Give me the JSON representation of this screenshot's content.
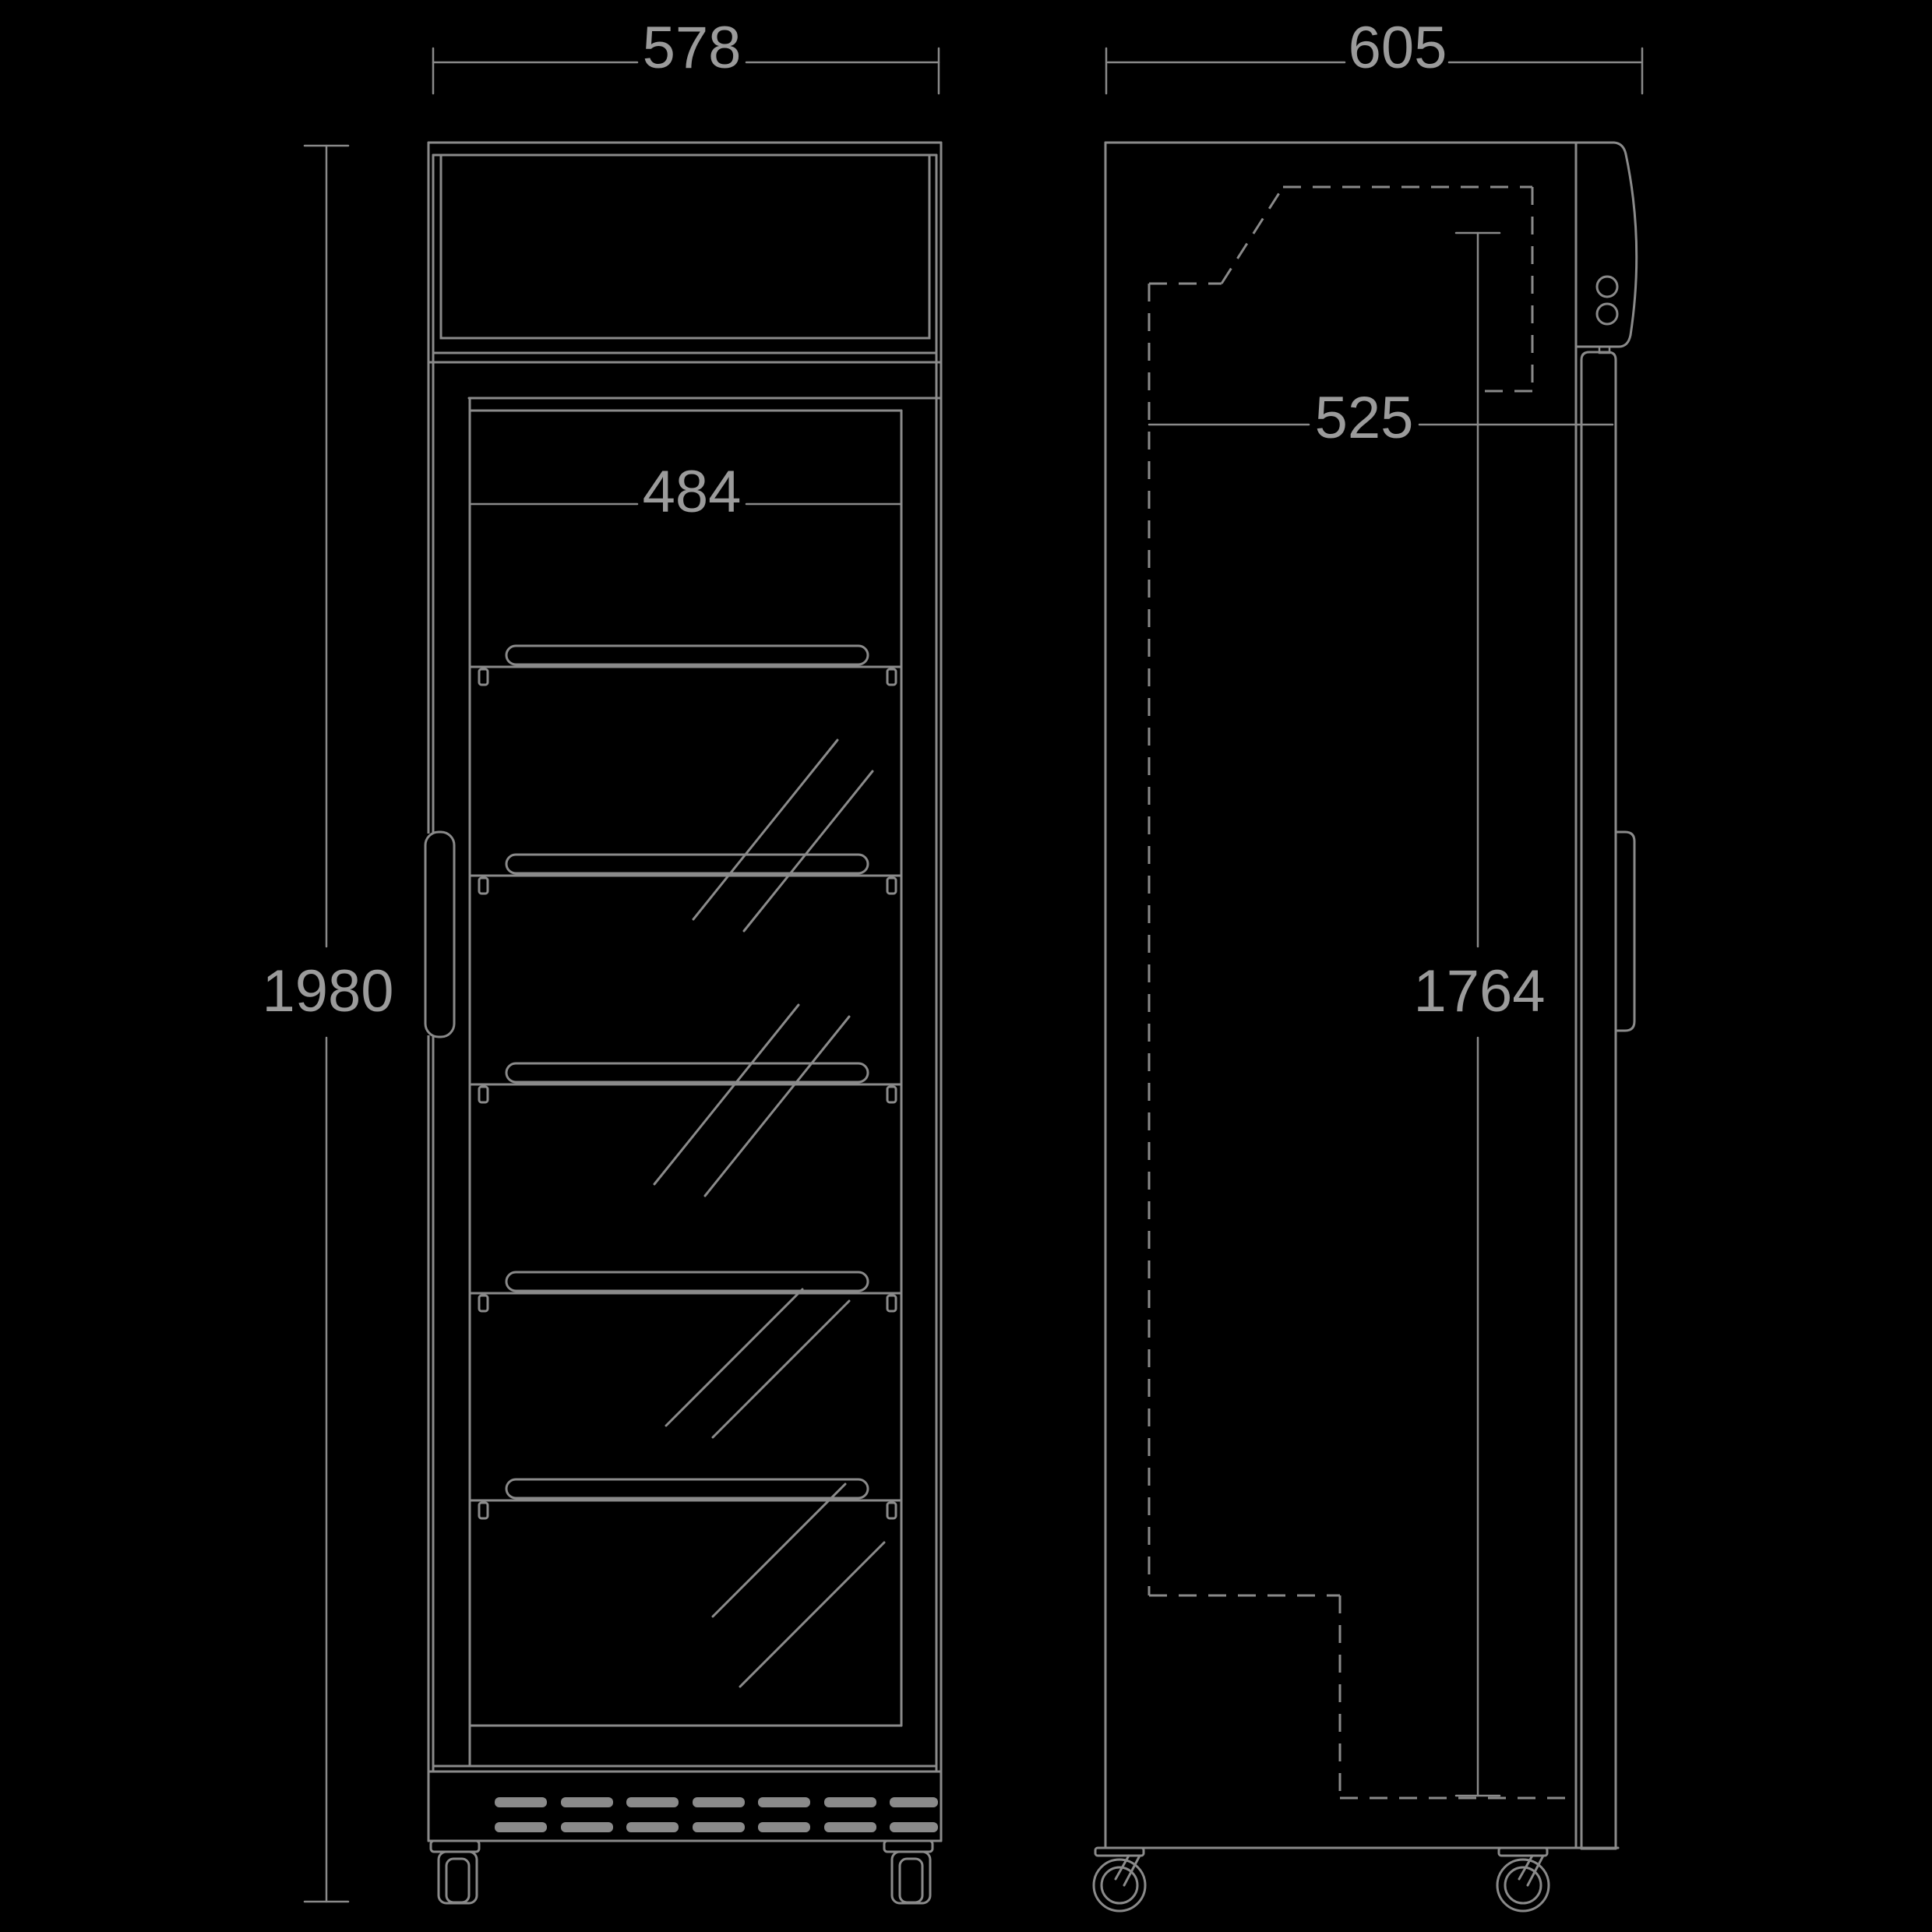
{
  "drawing": {
    "kind": "display-cooler-dimension-drawing",
    "colors": {
      "background": "#000000",
      "line": "#8a8a8a",
      "text": "#9b9b9b"
    },
    "dimensions": {
      "front_overall_width": "578",
      "front_inner_width": "484",
      "front_overall_height": "1980",
      "side_overall_depth": "605",
      "side_inner_depth": "525",
      "side_door_height": "1764"
    }
  }
}
